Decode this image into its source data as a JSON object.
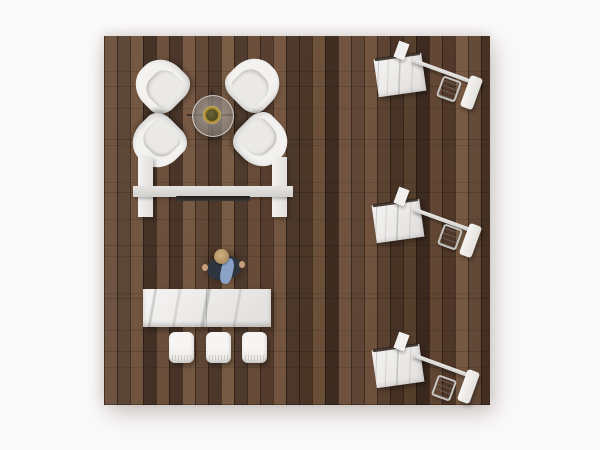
{
  "scene": {
    "description": "Top-down 3D render of a square exhibit space with dark walnut plank flooring on a white background",
    "floor": {
      "material": "dark walnut vertical planks"
    },
    "objects": {
      "lounge_chairs": {
        "label": "white tub lounge chair",
        "count": 4
      },
      "coffee_table": {
        "label": "round glass coffee table with brass planter",
        "count": 1
      },
      "media_wall": {
        "label": "freestanding media wall with two white towers and a dark screen",
        "count": 1
      },
      "person": {
        "label": "standing person in dark top with blue jacket",
        "count": 1
      },
      "marble_table": {
        "label": "white marble console table",
        "count": 1
      },
      "stools": {
        "label": "white upholstered stool",
        "count": 3
      },
      "demo_kiosks": {
        "label": "angled marble demo kiosk with rail, wire stool and end panel",
        "count": 3
      }
    }
  },
  "colors": {
    "page_bg": "#fbfafa",
    "floor_dark": "#3e2a1e",
    "floor_mid": "#5e4331",
    "floor_light": "#75553e",
    "white_furniture": "#f3f2f0",
    "marble": "#ebe9e7",
    "beam_gray": "#d2d0cc",
    "screen_dark": "#3a3835",
    "table_ring_gold": "#a8862f",
    "plant_green": "#4d4823",
    "person_shirt": "#2e3540",
    "person_jacket": "#8aa2c6",
    "person_skin": "#a98a5e"
  }
}
